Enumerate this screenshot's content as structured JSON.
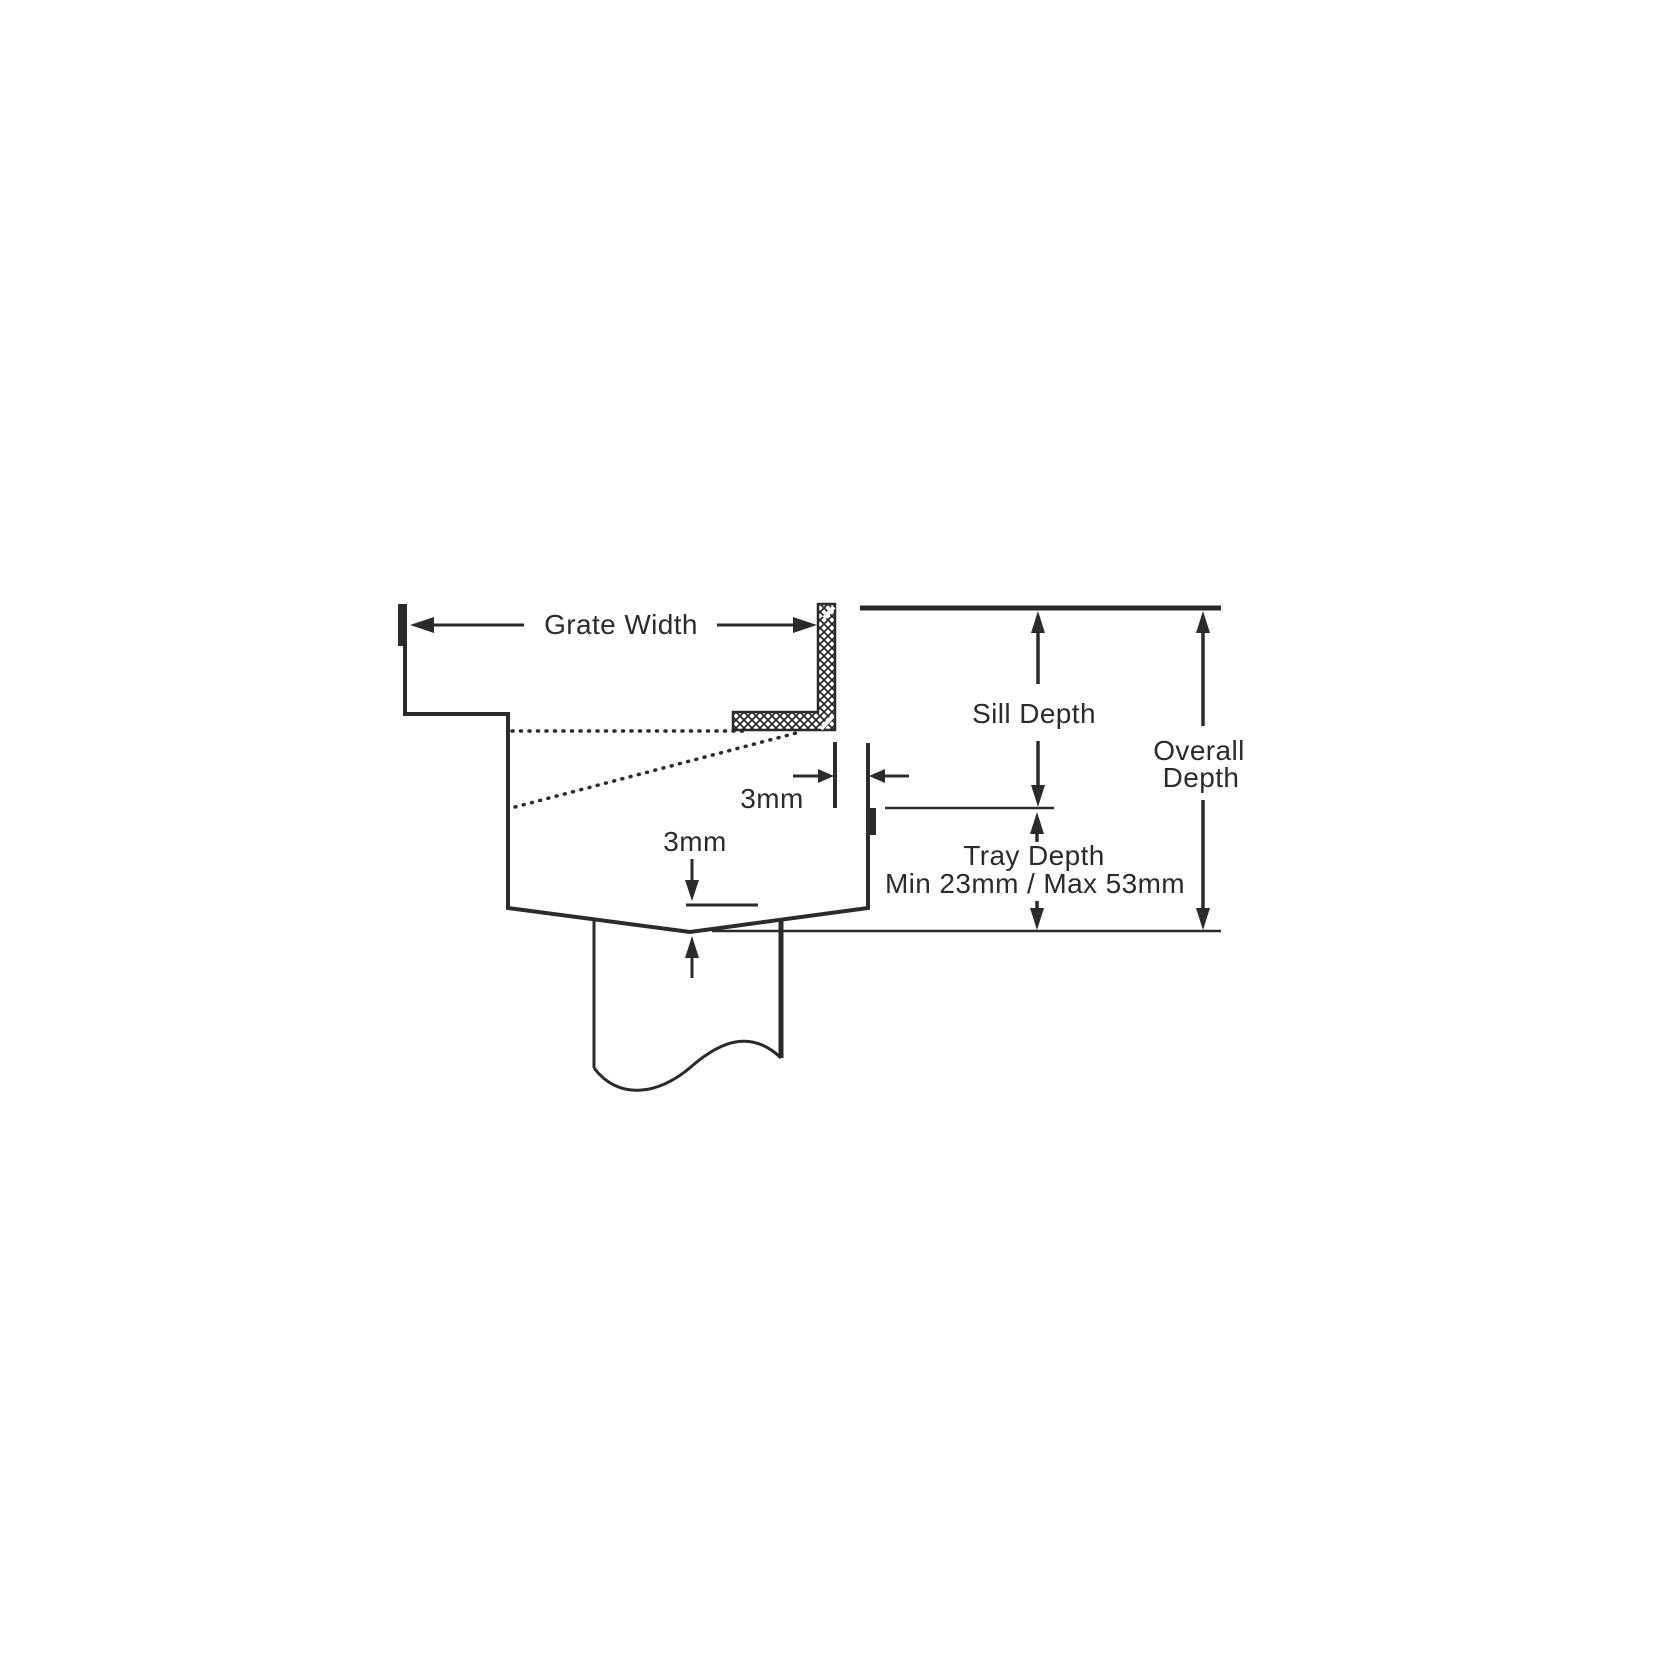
{
  "diagram": {
    "title": "Drain tray cross-section dimension diagram",
    "labels": {
      "grate_width": "Grate Width",
      "sill_depth": "Sill Depth",
      "overall_depth_line1": "Overall",
      "overall_depth_line2": "Depth",
      "tray_depth_line1": "Tray Depth",
      "tray_depth_line2": "Min 23mm / Max 53mm",
      "grate_gap": "3mm",
      "tray_thickness": "3mm"
    },
    "colors": {
      "line": "#2b2b2b",
      "background": "#ffffff"
    }
  }
}
